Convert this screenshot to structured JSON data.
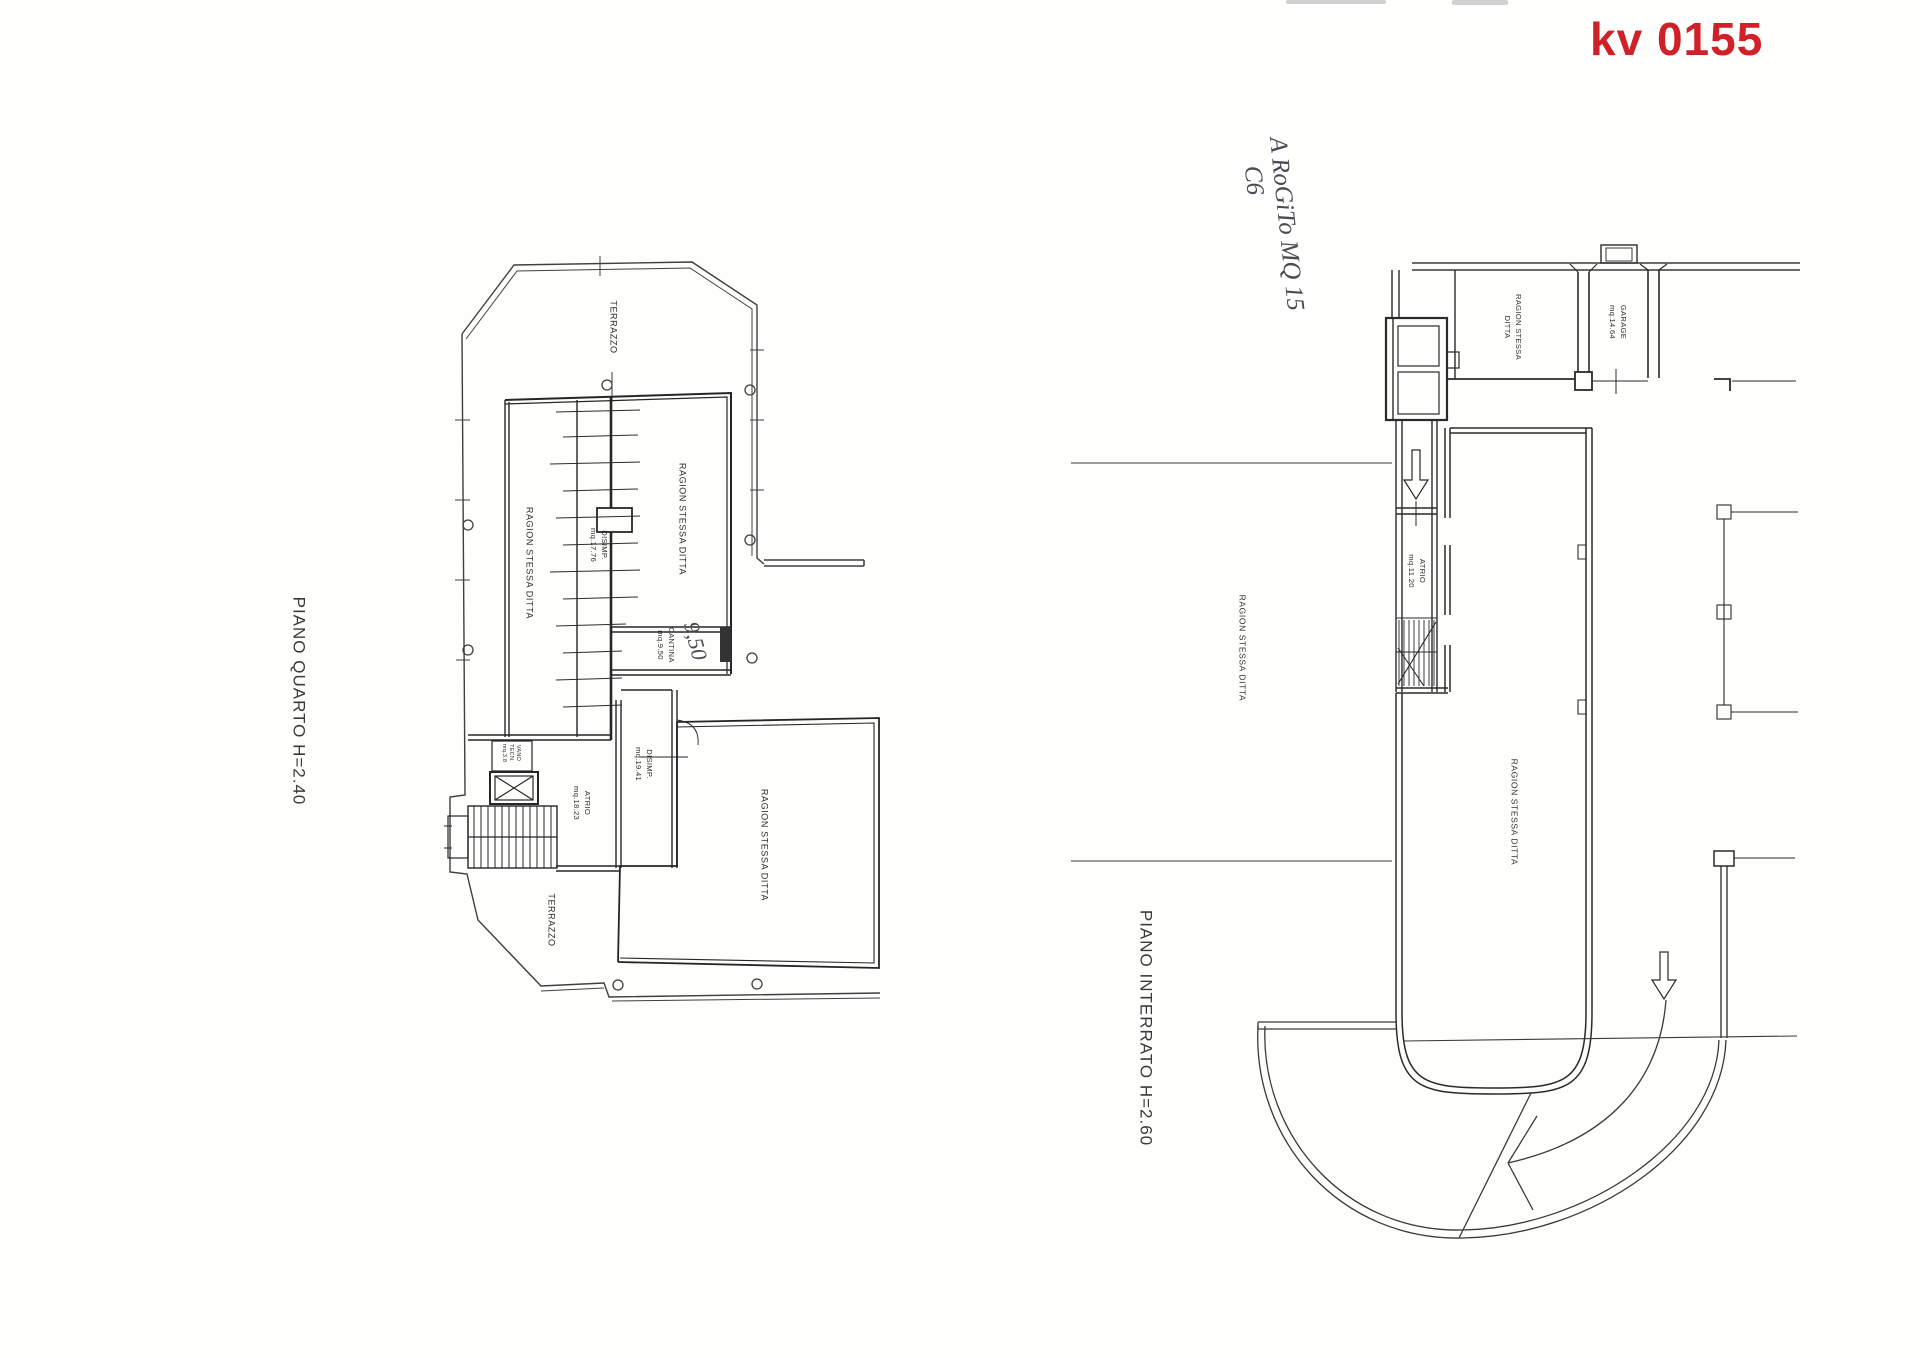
{
  "code": {
    "text": "kv 0155",
    "color": "#cf2127"
  },
  "handwriting": {
    "line1": "A RoGiTo MQ 15",
    "line2": "C6",
    "cantina_value": "9,50"
  },
  "quarto": {
    "title": "PIANO QUARTO H=2.40",
    "terrazzo_top": "TERRAZZO",
    "ragion_left": "RAGION STESSA DITTA",
    "ragion_right": "RAGION STESSA DITTA",
    "disimp1_name": "DISIMP.",
    "disimp1_area": "mq.17.76",
    "cantina_name": "CANTINA",
    "cantina_area": "mq.9.50",
    "disimp2_name": "DISIMP.",
    "disimp2_area": "mq.19.41",
    "atrio_name": "ATRIO",
    "atrio_area": "mq.18.23",
    "vano_l1": "VANO",
    "vano_l2": "TECN.",
    "vano_l3": "mq.3.8",
    "terrazzo_bottom": "TERRAZZO",
    "ragion_bottom": "RAGION STESSA DITTA"
  },
  "interrato": {
    "title": "PIANO INTERRATO H=2.60",
    "ragion_garage_l1": "RAGION STESSA",
    "ragion_garage_l2": "DITTA",
    "garage_name": "GARAGE",
    "garage_area": "mq.14.64",
    "atrio_name": "ATRIO",
    "atrio_area": "mq.11.20",
    "ragion_west": "RAGION STESSA DITTA",
    "ragion_central": "RAGION STESSA DITTA"
  }
}
